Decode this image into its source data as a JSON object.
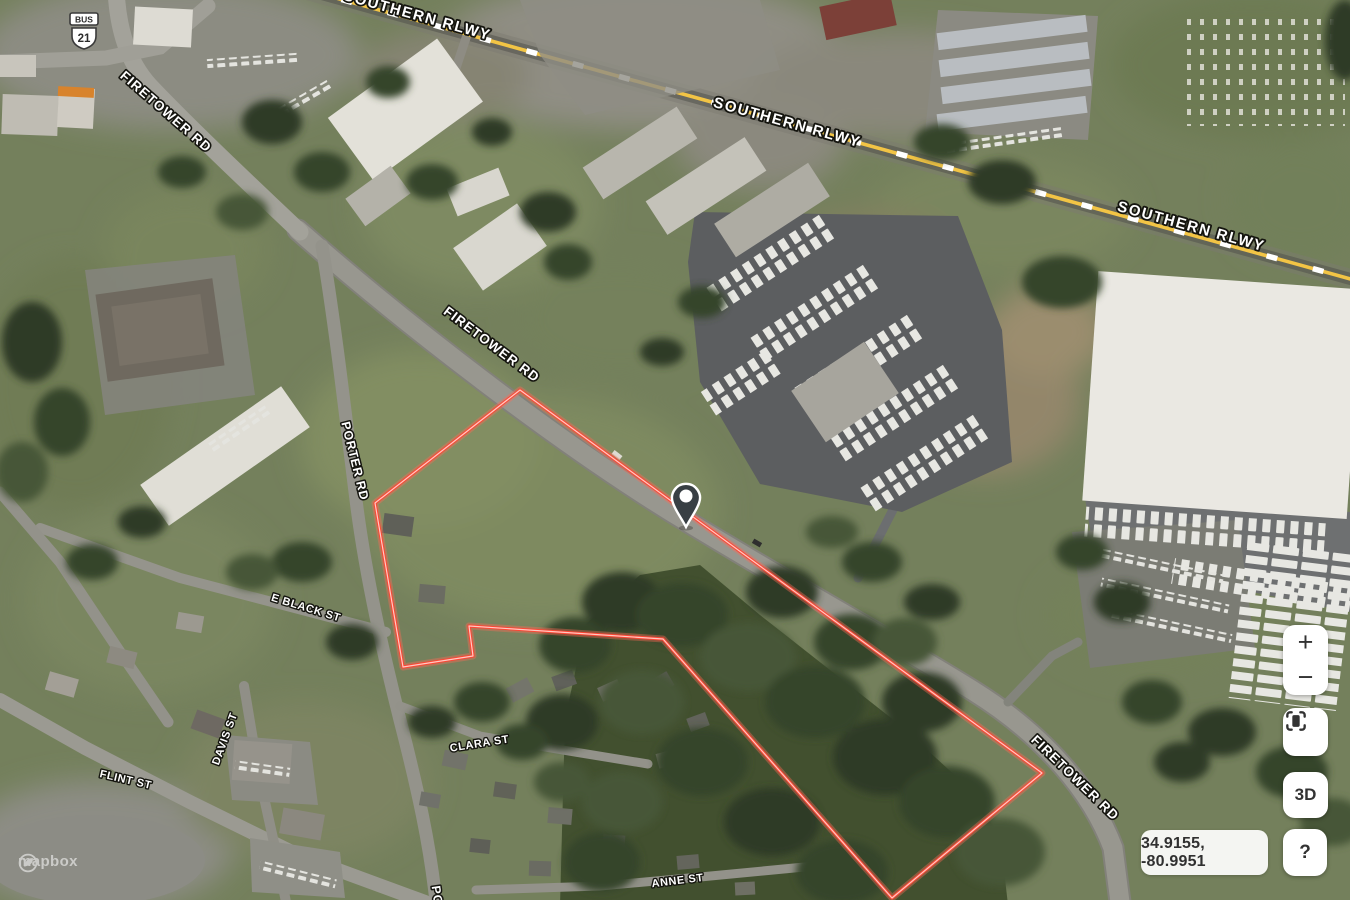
{
  "map": {
    "road_labels": {
      "southern_rlwy": "SOUTHERN RLWY",
      "firetower_rd": "FIRETOWER RD",
      "porter_rd": "PORTER RD",
      "porter_rd_partial": "PO",
      "e_black_st": "E BLACK ST",
      "davis_st": "DAVIS ST",
      "flint_st": "FLINT ST",
      "clara_st": "CLARA ST",
      "anne_st": "ANNE ST"
    },
    "shield": {
      "banner": "BUS",
      "number": "21"
    },
    "parcel": {
      "points": "520,390 375,503 403,667 473,656 469,626 663,639 892,898 1042,773",
      "outline_color": "#ff4635"
    },
    "marker": {
      "name": "property-marker",
      "fill": "#383f44"
    },
    "railway_color": "#f2c445"
  },
  "controls": {
    "zoom_in_label": "+",
    "zoom_out_label": "−",
    "three_d_label": "3D",
    "help_label": "?",
    "coordinates": "34.9155, -80.9951"
  },
  "attribution": {
    "brand": "mapbox"
  }
}
